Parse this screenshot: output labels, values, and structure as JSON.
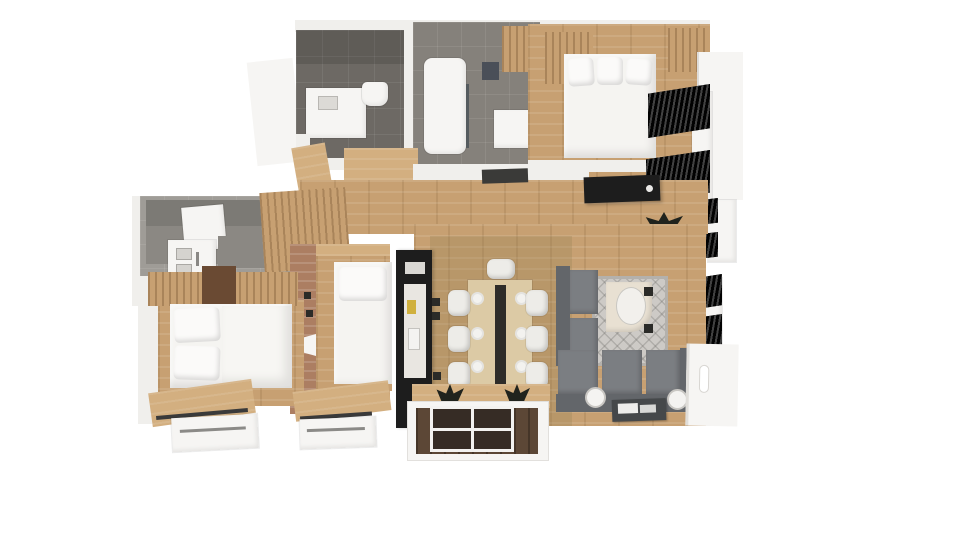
{
  "scene": {
    "kind": "3d-floor-plan-top-down-render",
    "background": "#ffffff",
    "visible_text": "none"
  },
  "palette": {
    "bg": "#ffffff",
    "wall": "#f0efec",
    "wall-soft": "#f6f5f3",
    "oak": "#c7a072",
    "oak-light": "#d3af80",
    "tile": "#85817b",
    "tile-dark": "#6d6964",
    "counter": "#8b8883",
    "white-obj": "#f6f5f3",
    "black-obj": "#1d1d1d",
    "walnut": "#6a4a33",
    "brick": "#ac7e62",
    "sofa": "#7b7e82",
    "sofa-dark": "#63666a",
    "rug": "#cdcac6",
    "rug-border": "#b4b1ac",
    "deck": "#5c4736",
    "deck-dark": "#362c25",
    "plant": "#20231d",
    "yellow": "#d0b03e",
    "glass": "#555b5e"
  },
  "rooms": [
    {
      "id": "bathroom-small",
      "contents": [
        "shower-tray",
        "toilet",
        "vanity-counter",
        "dark-slate-tile-floor"
      ]
    },
    {
      "id": "bathroom-main",
      "contents": [
        "bathtub-shower",
        "glass-screen",
        "vanity",
        "wood-cabinet",
        "slate-tile-floor"
      ]
    },
    {
      "id": "bedroom-master",
      "contents": [
        "double-bed-3-pillows",
        "wood-headboard-cabinets",
        "black-sideboard",
        "window-shutters"
      ]
    },
    {
      "id": "hallway",
      "contents": [
        "oak-plank-floor",
        "black-sideboard",
        "doormat",
        "potted-plant"
      ]
    },
    {
      "id": "kitchen-utility",
      "contents": [
        "gray-counter",
        "sink",
        "white-appliance",
        "wood-slat-cabinets"
      ]
    },
    {
      "id": "bedroom-single",
      "contents": [
        "single-bed",
        "brick-wall",
        "wall-sockets",
        "window-with-railing"
      ]
    },
    {
      "id": "kitchen-black-unit",
      "contents": [
        "tall-black-cabinets",
        "worktop",
        "yellow-accessory"
      ]
    },
    {
      "id": "dining-area",
      "contents": [
        "dining-table",
        "table-runner",
        "eight-white-chairs",
        "place-settings"
      ]
    },
    {
      "id": "living-room",
      "contents": [
        "l-shaped-gray-sofa",
        "diamond-pattern-rug",
        "desk-with-chair",
        "coffee-table-magazines",
        "two-globe-floor-lamps",
        "window-shutters"
      ]
    },
    {
      "id": "bedroom-double",
      "contents": [
        "double-bed-4-pillows",
        "wood-wardrobe",
        "walnut-cabinet",
        "window-with-railing"
      ]
    },
    {
      "id": "balcony",
      "contents": [
        "dark-wood-decking",
        "white-railing-frame",
        "two-spiky-plants",
        "four-dark-deck-panels"
      ]
    }
  ]
}
